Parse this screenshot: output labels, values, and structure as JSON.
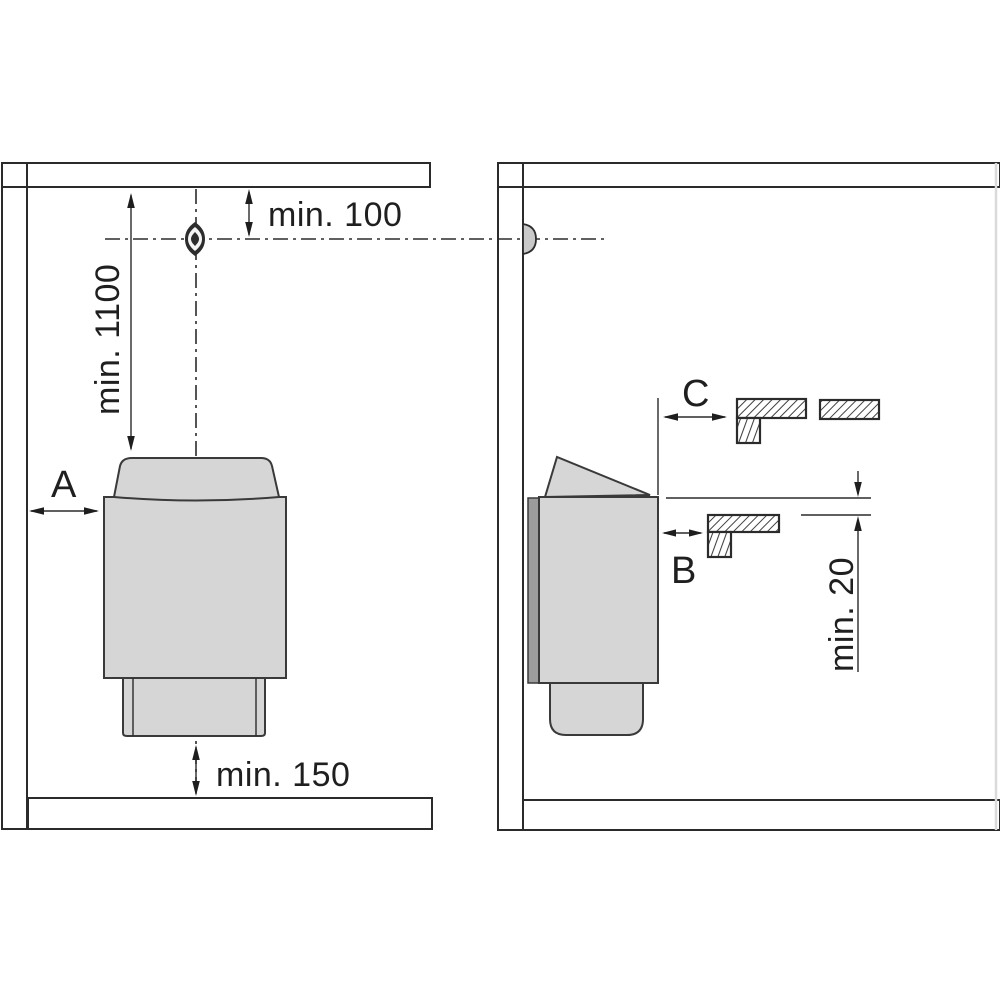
{
  "diagram": {
    "type": "heater-installation-clearance-drawing",
    "views": {
      "front": {
        "side_clearance_label": "A",
        "dim_sensor_to_ceiling": "min. 100",
        "dim_heater_top_to_ceiling": "min. 1100",
        "dim_heater_bottom_to_floor": "min. 150"
      },
      "side": {
        "bench_front_clearance_label": "C",
        "bench_side_clearance_label": "B",
        "dim_heater_top_to_bench": "min. 20"
      }
    },
    "colors": {
      "line": "#2b2b2b",
      "heater_fill": "#d6d6d6",
      "heater_stroke": "#3a3a3a",
      "bracket_fill": "#9c9c9c",
      "sensor_fill": "#2d2d2d",
      "separator_gray": "#9e9e9e",
      "background": "#ffffff"
    }
  }
}
